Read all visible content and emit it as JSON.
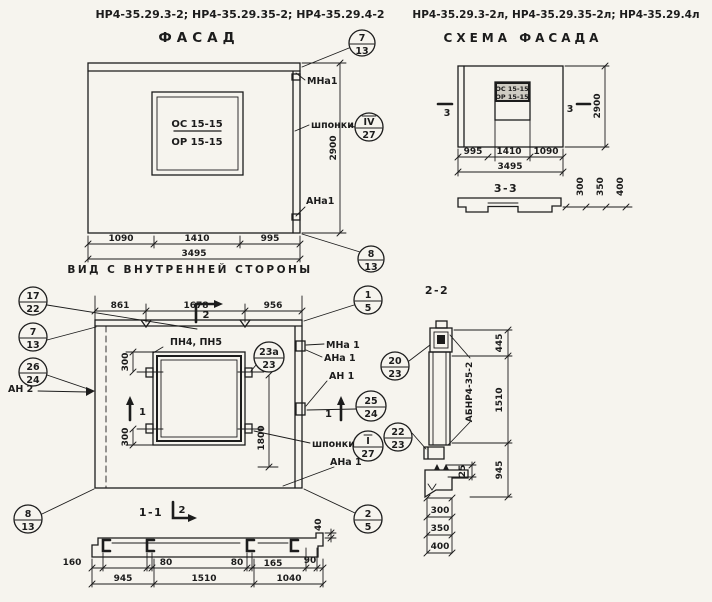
{
  "colors": {
    "paper": "#f6f4ee",
    "ink": "#1c1c1c"
  },
  "facade": {
    "header": "НР4-35.29.3-2; НР4-35.29.35-2; НР4-35.29.4-2",
    "title": "ФАСАД",
    "subtitle": "ВИД С ВНУТРЕННЕЙ СТОРОНЫ",
    "window": {
      "top": "ОС 15-15",
      "bottom": "ОР 15-15"
    },
    "dims": {
      "w1": "1090",
      "w2": "1410",
      "w3": "995",
      "total": "3495",
      "height": "2900"
    },
    "labels": {
      "mna": "МНа1",
      "shponki": "шпонки",
      "ana": "АНа1"
    },
    "callouts": {
      "top": {
        "n": "7",
        "d": "13"
      },
      "key": {
        "n": "IV",
        "d": "27"
      },
      "bottom": {
        "n": "8",
        "d": "13"
      }
    }
  },
  "scheme": {
    "header": "НР4-35.29.3-2л, НР4-35.29.35-2л; НР4-35.29.4л",
    "title": "СХЕМА ФАСАДА",
    "window": {
      "top": "ОС 15-15",
      "bottom": "ОР 15-15"
    },
    "section_mark": "3",
    "dims": {
      "w1": "995",
      "w2": "1410",
      "w3": "1090",
      "total": "3495",
      "height": "2900"
    },
    "section": {
      "label": "3-3",
      "dims": [
        "300",
        "350",
        "400"
      ]
    }
  },
  "inner": {
    "dims_top": [
      "861",
      "1678",
      "956"
    ],
    "window_label": "ПН4, ПН5",
    "dims": {
      "offset": "300",
      "height": "1800"
    },
    "labels": {
      "mna": "МНа 1",
      "ana": "АНа 1",
      "an1": "АН 1",
      "shponki": "шпонки",
      "ana2": "АНа 1",
      "an2": "АН 2"
    },
    "marks": {
      "s1": "1",
      "s2": "2"
    },
    "callouts": {
      "c17": {
        "n": "17",
        "d": "22"
      },
      "c7": {
        "n": "7",
        "d": "13"
      },
      "c26": {
        "n": "26",
        "d": "24"
      },
      "c23a": {
        "n": "23а",
        "d": "23"
      },
      "c1": {
        "n": "1",
        "d": "5"
      },
      "c25": {
        "n": "25",
        "d": "24"
      },
      "key": {
        "n": "I",
        "d": "27"
      },
      "c2": {
        "n": "2",
        "d": "5"
      },
      "c8": {
        "n": "8",
        "d": "13"
      }
    }
  },
  "section11": {
    "label": "1-1",
    "mark": "2",
    "dims_row1": [
      "160",
      "80",
      "80",
      "165",
      "90"
    ],
    "dims_row2": [
      "945",
      "1510",
      "1040"
    ],
    "dim_top": "40"
  },
  "section22": {
    "label": "2-2",
    "panel_mark": "АБНР4-35-2",
    "dims": {
      "d1": "445",
      "d2": "1510",
      "d3": "945",
      "small": "25"
    },
    "ladder": [
      "300",
      "350",
      "400"
    ],
    "callouts": {
      "c20": {
        "n": "20",
        "d": "23"
      },
      "c22": {
        "n": "22",
        "d": "23"
      }
    }
  }
}
